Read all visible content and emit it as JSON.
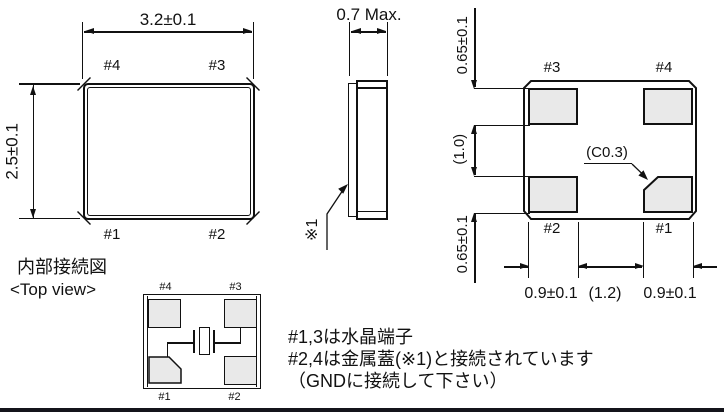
{
  "package_top_view": {
    "width_dim": "3.2±0.1",
    "height_dim": "2.5±0.1",
    "pad_labels": {
      "top_left": "#4",
      "top_right": "#3",
      "bottom_left": "#1",
      "bottom_right": "#2"
    }
  },
  "side_view": {
    "thickness_dim": "0.7 Max.",
    "lid_note_ref": "※1"
  },
  "bottom_view": {
    "pad_labels": {
      "top_left": "#3",
      "top_right": "#4",
      "bottom_left": "#2",
      "bottom_right": "#1"
    },
    "chamfer_dim": "(C0.3)",
    "vertical_dims": [
      "0.65±0.1",
      "(1.0)",
      "0.65±0.1"
    ],
    "horizontal_dims": [
      "0.9±0.1",
      "(1.2)",
      "0.9±0.1"
    ]
  },
  "internal_connection": {
    "title": "内部接続図",
    "view_label": "<Top view>",
    "pad_labels": {
      "top_left": "#4",
      "top_right": "#3",
      "bottom_left": "#1",
      "bottom_right": "#2"
    }
  },
  "notes": [
    "#1,3は水晶端子",
    "#2,4は金属蓋(※1)と接続されています",
    "（GNDに接続して下さい）"
  ],
  "colors": {
    "line": "#111111",
    "pad_fill": "#e9e9e9",
    "bottom_bar": "#14141b",
    "background": "#ffffff"
  }
}
